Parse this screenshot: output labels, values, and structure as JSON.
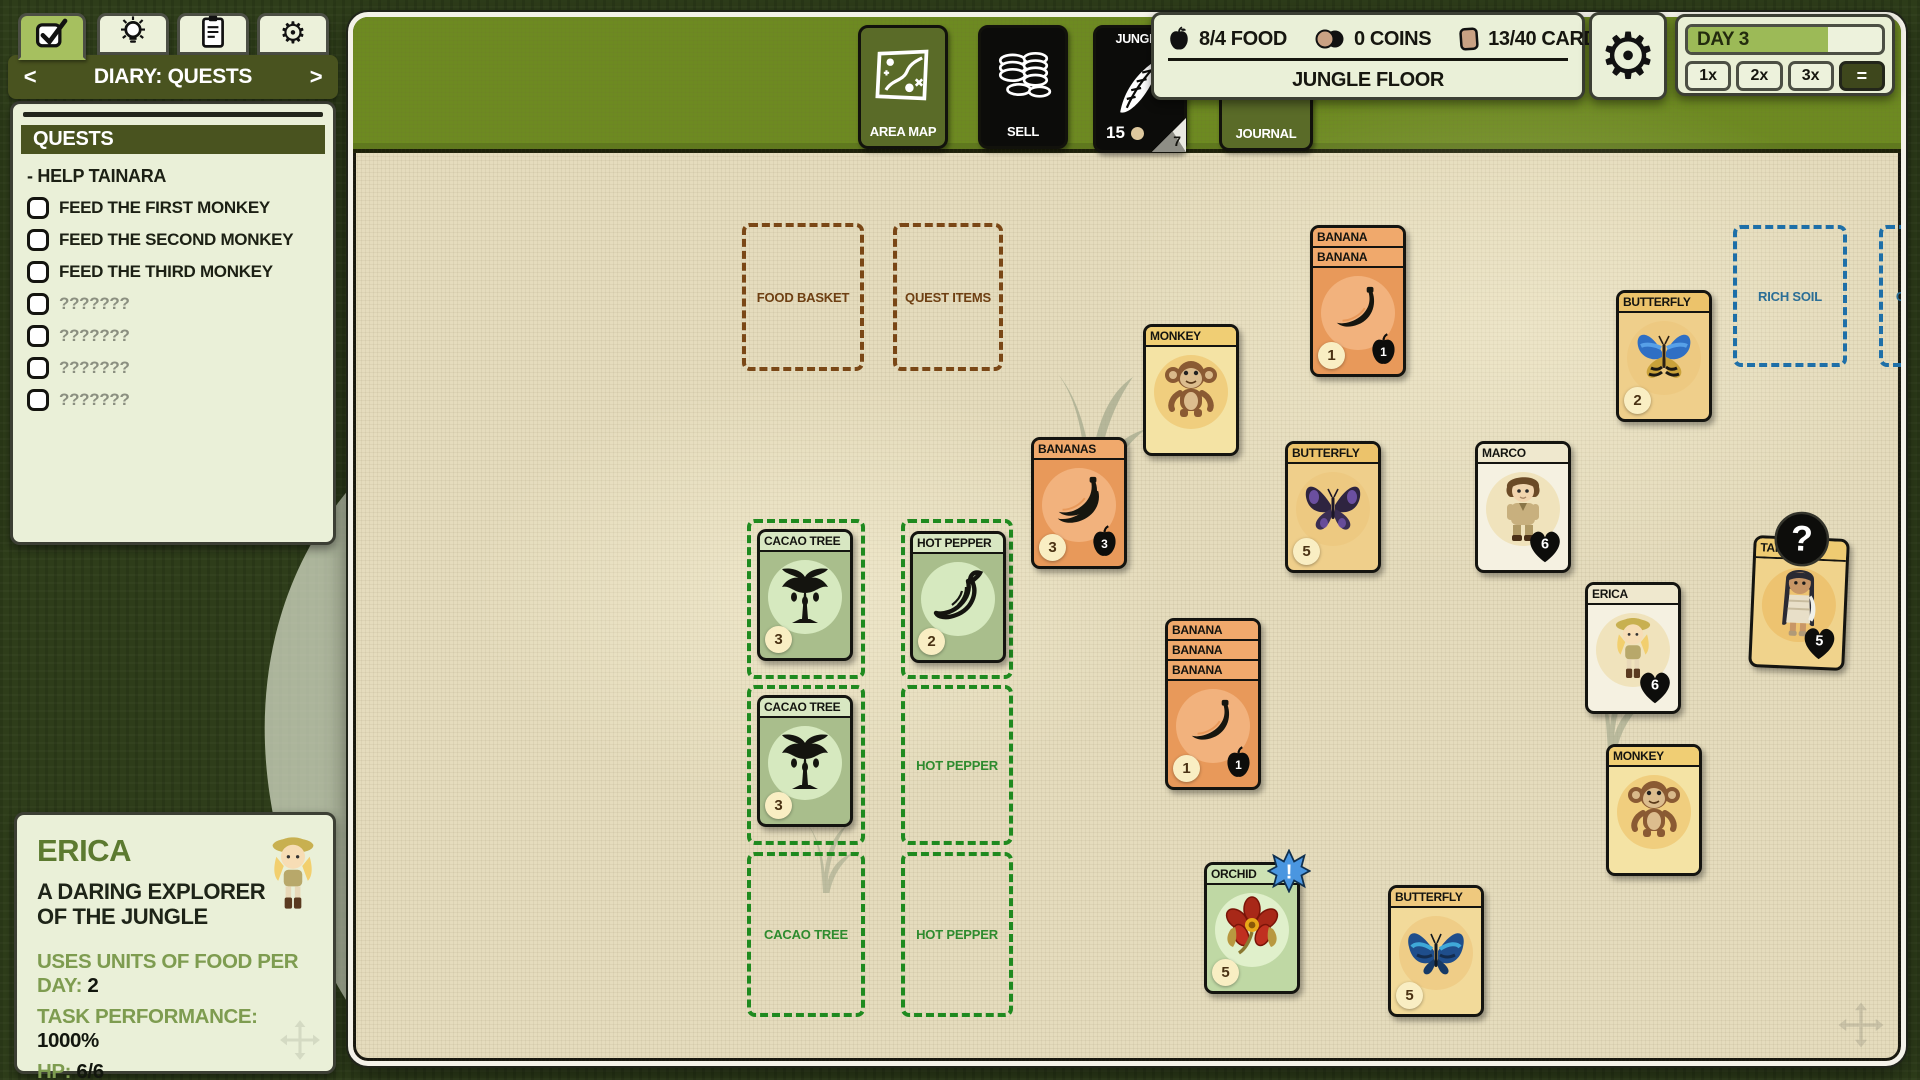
{
  "colors": {
    "board_bg": "#E5DCBD",
    "bar_green": "#6D8A21",
    "panel_cream": "#EAF0D8",
    "olive_dark": "#49531F",
    "tab_active": "#A6C05F",
    "day_fill": "#9CBA57",
    "slot_brown": "#7A4716",
    "slot_blue": "#1E6FA8",
    "slot_green": "#1F8A1F",
    "card_types": {
      "fruit": {
        "body": "#E8995A",
        "title": "#F0A96C",
        "circle": "#F2B27D"
      },
      "animal": {
        "body": "#F4E3A4",
        "title": "#F0CE74",
        "circle": "#F0CE7E"
      },
      "insect": {
        "body": "#EFCF8B",
        "title": "#ECC36B",
        "circle": "#EDC981"
      },
      "insect2": {
        "body": "#F2DA9A",
        "title": "#EFC97E",
        "circle": "#EFCD87"
      },
      "person": {
        "body": "#F5F1E1",
        "title": "#EFE8CE",
        "circle": "#F0E3BC"
      },
      "tainara": {
        "body": "#F0D38C",
        "title": "#EFCB72",
        "circle": "#EDC370"
      },
      "plant": {
        "body": "#A9BE8C",
        "title": "#D8E7C2",
        "circle": "#D6E9BF"
      },
      "orchid": {
        "body": "#BFD8A4",
        "title": "#CDE2B4",
        "circle": "#E0F0CB"
      },
      "ants": {
        "body": "#BE9EC6",
        "title": "#C9ADD0",
        "circle": "#D9C7DE"
      }
    }
  },
  "tabs": [
    {
      "id": "quests",
      "icon": "check-icon",
      "active": true
    },
    {
      "id": "ideas",
      "icon": "lightbulb-icon",
      "active": false
    },
    {
      "id": "cardlist",
      "icon": "clipboard-icon",
      "active": false
    },
    {
      "id": "settings",
      "icon": "gear-icon",
      "active": false
    }
  ],
  "diary": {
    "title": "DIARY: QUESTS",
    "prev": "<",
    "next": ">"
  },
  "quests": {
    "header": "QUESTS",
    "group": "- HELP TAINARA",
    "items": [
      {
        "label": "FEED THE FIRST MONKEY",
        "unknown": false
      },
      {
        "label": "FEED THE SECOND MONKEY",
        "unknown": false
      },
      {
        "label": "FEED THE THIRD MONKEY",
        "unknown": false
      },
      {
        "label": "???????",
        "unknown": true
      },
      {
        "label": "???????",
        "unknown": true
      },
      {
        "label": "???????",
        "unknown": true
      },
      {
        "label": "???????",
        "unknown": true
      }
    ]
  },
  "top_bar": {
    "area_map": "AREA MAP",
    "sell": "SELL",
    "journal": "JOURNAL",
    "deck": {
      "title": "JUNGLE",
      "count": "15",
      "corner": "7"
    }
  },
  "resources": {
    "food": "8/4 FOOD",
    "coins": "0 COINS",
    "cards": "13/40 CARDS",
    "location": "JUNGLE FLOOR"
  },
  "day": {
    "label": "DAY 3",
    "progress_pct": 72,
    "speeds": [
      "1x",
      "2x",
      "3x"
    ],
    "pause": "="
  },
  "board": {
    "slots": [
      {
        "label": "FOOD BASKET",
        "color": "brown",
        "x": 389,
        "y": 206,
        "w": 122,
        "h": 148
      },
      {
        "label": "QUEST ITEMS",
        "color": "brown",
        "x": 540,
        "y": 206,
        "w": 110,
        "h": 148
      },
      {
        "label": "RICH SOIL",
        "color": "blue",
        "x": 1380,
        "y": 208,
        "w": 114,
        "h": 142
      },
      {
        "label": "COCOA BEAN",
        "color": "blue",
        "x": 1526,
        "y": 208,
        "w": 120,
        "h": 142
      },
      {
        "label": "HOT PEPPER",
        "color": "blue",
        "x": 1673,
        "y": 208,
        "w": 114,
        "h": 142
      },
      {
        "label": "",
        "color": "green",
        "x": 394,
        "y": 502,
        "w": 118,
        "h": 160
      },
      {
        "label": "",
        "color": "green",
        "x": 394,
        "y": 668,
        "w": 118,
        "h": 160
      },
      {
        "label": "CACAO TREE",
        "color": "green",
        "x": 394,
        "y": 835,
        "w": 118,
        "h": 165
      },
      {
        "label": "",
        "color": "green",
        "x": 548,
        "y": 502,
        "w": 112,
        "h": 160
      },
      {
        "label": "HOT PEPPER",
        "color": "green",
        "x": 548,
        "y": 668,
        "w": 112,
        "h": 160
      },
      {
        "label": "HOT PEPPER",
        "color": "green",
        "x": 548,
        "y": 835,
        "w": 112,
        "h": 165
      }
    ],
    "cards": [
      {
        "titles": [
          "BANANA",
          "BANANA"
        ],
        "type": "fruit",
        "icon": "banana-icon",
        "cost": "1",
        "food": "1",
        "x": 957,
        "y": 208
      },
      {
        "titles": [
          "MONKEY"
        ],
        "type": "animal",
        "icon": "monkey-icon",
        "x": 790,
        "y": 307
      },
      {
        "titles": [
          "BANANAS"
        ],
        "type": "fruit",
        "icon": "bananas-icon",
        "cost": "3",
        "food": "3",
        "x": 678,
        "y": 420
      },
      {
        "titles": [
          "BUTTERFLY"
        ],
        "type": "insect",
        "icon": "butterfly-purple-icon",
        "cost": "5",
        "x": 932,
        "y": 424
      },
      {
        "titles": [
          "MARCO"
        ],
        "type": "person",
        "icon": "marco-icon",
        "heart": "6",
        "x": 1122,
        "y": 424
      },
      {
        "titles": [
          "BUTTERFLY"
        ],
        "type": "insect",
        "icon": "butterfly-blueorange-icon",
        "cost": "2",
        "x": 1263,
        "y": 273
      },
      {
        "titles": [
          "ERICA"
        ],
        "type": "person",
        "icon": "erica-icon",
        "heart": "6",
        "x": 1232,
        "y": 565
      },
      {
        "titles": [
          "TAINARA"
        ],
        "type": "tainara",
        "icon": "tainara-icon",
        "heart": "5",
        "x": 1398,
        "y": 520,
        "rot": 2.5,
        "unknown": true
      },
      {
        "titles": [
          "ANTS"
        ],
        "type": "ants",
        "icon": "ants-icon",
        "x": 1705,
        "y": 512,
        "rot": -2
      },
      {
        "titles": [
          "BANANA",
          "BANANA",
          "BANANA"
        ],
        "type": "fruit",
        "icon": "banana-icon",
        "cost": "1",
        "food": "1",
        "x": 812,
        "y": 601
      },
      {
        "titles": [
          "MONKEY"
        ],
        "type": "animal",
        "icon": "monkey-icon",
        "x": 1253,
        "y": 727
      },
      {
        "titles": [
          "ORCHID"
        ],
        "type": "orchid",
        "icon": "orchid-icon",
        "cost": "5",
        "alert": "!",
        "x": 851,
        "y": 845
      },
      {
        "titles": [
          "BUTTERFLY"
        ],
        "type": "insect2",
        "icon": "butterfly-blue-icon",
        "cost": "5",
        "x": 1035,
        "y": 868
      },
      {
        "titles": [
          "MONKEY"
        ],
        "type": "animal",
        "icon": "monkey-icon",
        "x": 1565,
        "y": 838
      },
      {
        "titles": [
          "CACAO TREE"
        ],
        "type": "plant",
        "icon": "cacao-tree-icon",
        "cost": "3",
        "x": 404,
        "y": 512
      },
      {
        "titles": [
          "CACAO TREE"
        ],
        "type": "plant",
        "icon": "cacao-tree-icon",
        "cost": "3",
        "x": 404,
        "y": 678
      },
      {
        "titles": [
          "HOT PEPPER"
        ],
        "type": "plant",
        "icon": "hot-pepper-icon",
        "cost": "2",
        "x": 557,
        "y": 514
      }
    ]
  },
  "erica_panel": {
    "name": "ERICA",
    "desc": "A DARING EXPLORER OF THE JUNGLE",
    "stats": [
      {
        "label": "USES UNITS OF FOOD PER DAY:",
        "value": "2"
      },
      {
        "label": "TASK PERFORMANCE:",
        "value": "1000%"
      },
      {
        "label": "HP:",
        "value": "6/6"
      }
    ]
  }
}
